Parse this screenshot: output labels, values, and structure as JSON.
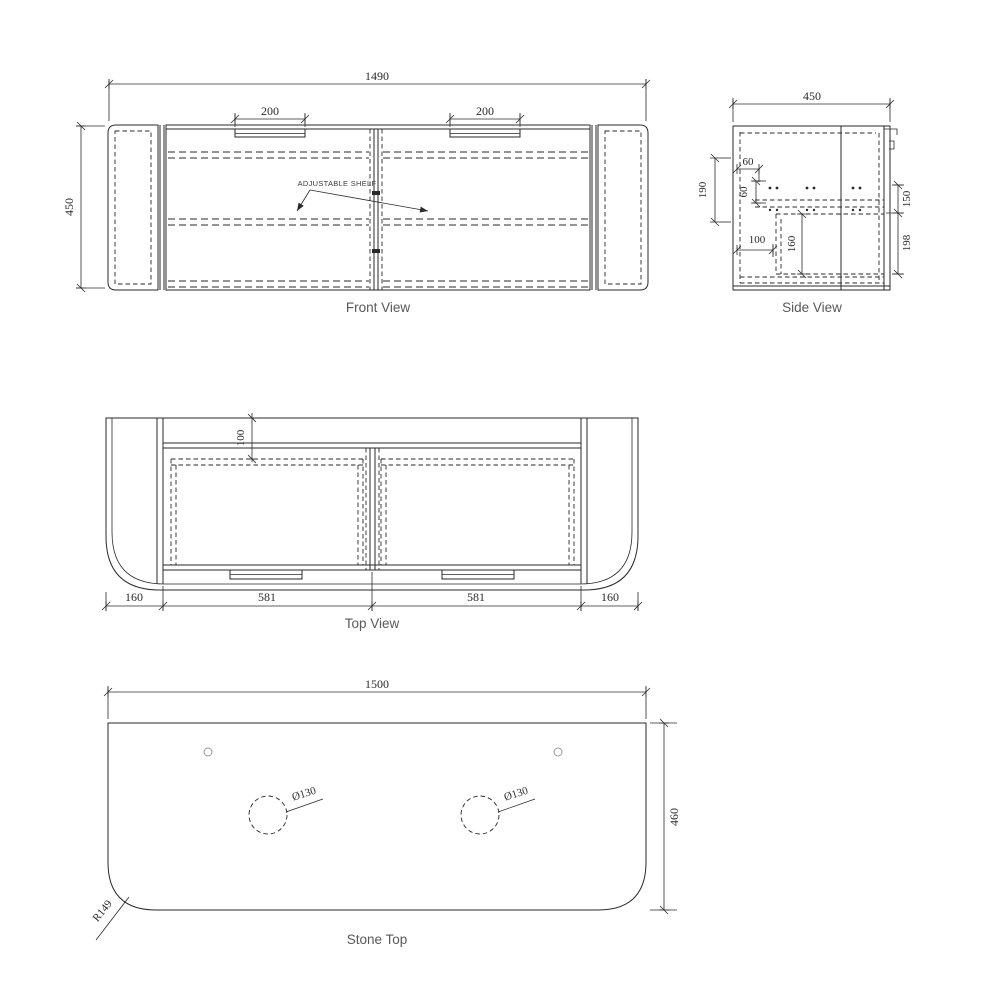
{
  "sheet_title": "Vanity cabinet technical drawing",
  "colors": {
    "line": "#2a2a2a",
    "dim_text": "#2b2b2b",
    "label_text": "#58595b",
    "background": "#ffffff"
  },
  "front_view": {
    "label": "Front View",
    "dim_width": "1490",
    "dim_height": "450",
    "dim_handle_left": "200",
    "dim_handle_right": "200",
    "shelf_note": "ADJUSTABLE SHELF"
  },
  "side_view": {
    "label": "Side View",
    "dim_width": "450",
    "dim_left_height": "190",
    "dim_hole_offset": "60",
    "dim_hole_gap": "60",
    "dim_drawer_inset": "100",
    "dim_drawer_height": "160",
    "dim_right_top": "150",
    "dim_right_bottom": "198"
  },
  "top_view": {
    "label": "Top View",
    "dim_back_inset": "100",
    "dim_left_end": "160",
    "dim_door_left": "581",
    "dim_door_right": "581",
    "dim_right_end": "160"
  },
  "stone_top": {
    "label": "Stone Top",
    "dim_width": "1500",
    "dim_depth": "460",
    "dim_hole_left": "Ø130",
    "dim_hole_right": "Ø130",
    "dim_corner_radius": "R149"
  }
}
